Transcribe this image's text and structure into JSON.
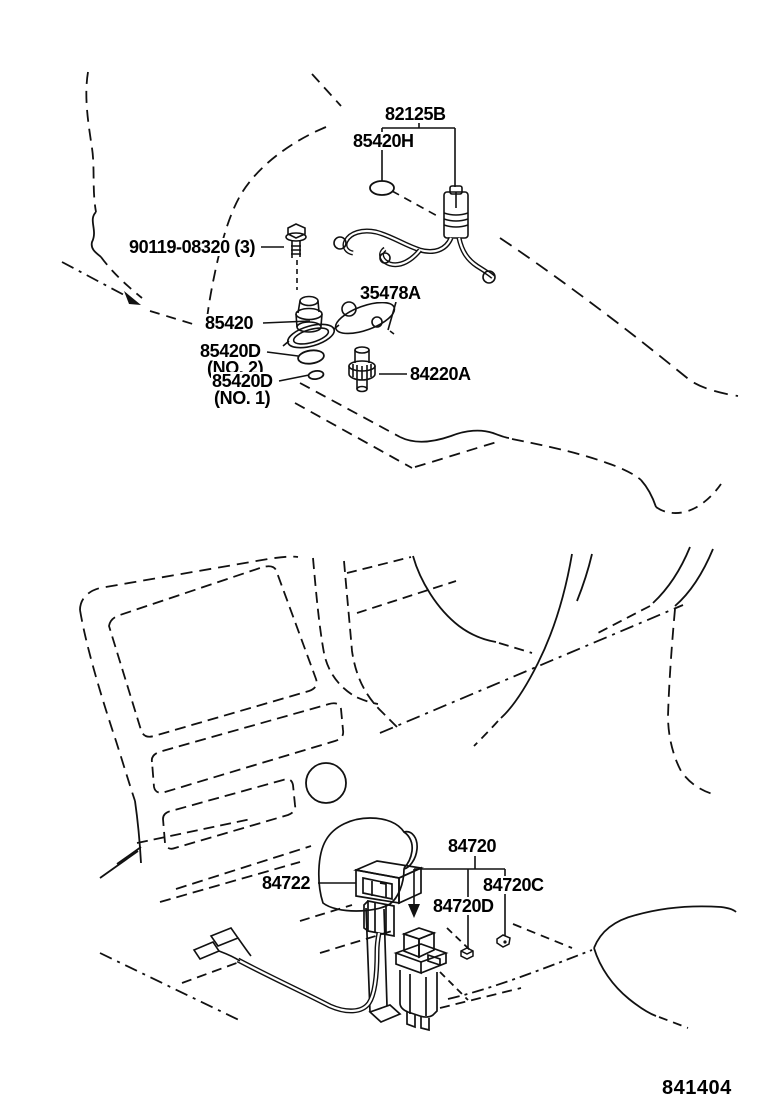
{
  "figure_code": "841404",
  "labels": {
    "p82125B": "82125B",
    "p85420H": "85420H",
    "bolt": "90119-08320 (3)",
    "p85420": "85420",
    "p35478A": "35478A",
    "p85420D": "85420D",
    "no2": "(NO. 2)",
    "p85420D1": "85420D",
    "no1": "(NO. 1)",
    "p84220A": "84220A",
    "p84720": "84720",
    "p84722": "84722",
    "p84720C": "84720C",
    "p84720D": "84720D"
  },
  "colors": {
    "line": "#111111",
    "background": "#ffffff"
  }
}
